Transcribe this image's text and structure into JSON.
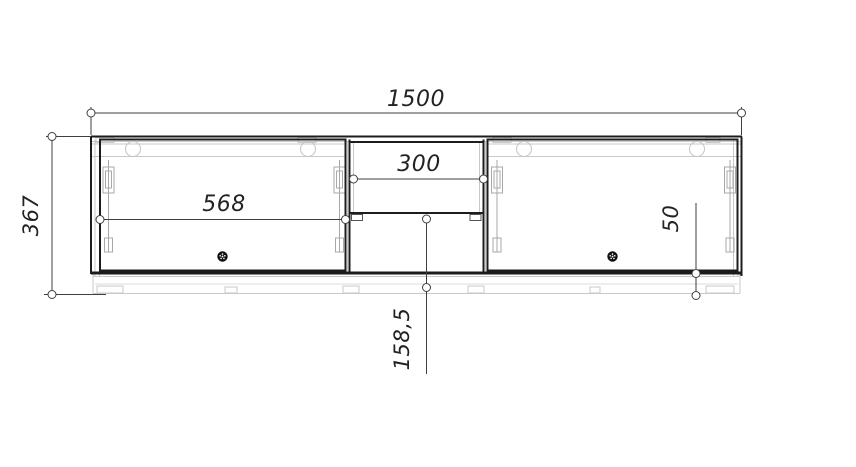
{
  "document": {
    "type": "furniture-front-elevation-drawing",
    "units": "mm"
  },
  "colors": {
    "background": "#ffffff",
    "outline": "#1c1c1c",
    "hardware_light": "#c6c6c6",
    "hardware_medium": "#a8a8a8",
    "dimension_line": "#3f3f3f",
    "text": "#222222",
    "knob": "#111111"
  },
  "dimensions": {
    "total_width": "1500",
    "total_height": "367",
    "left_door_width": "568",
    "niche_width": "300",
    "shelf_to_bottom": "158,5",
    "plinth_height": "50"
  }
}
